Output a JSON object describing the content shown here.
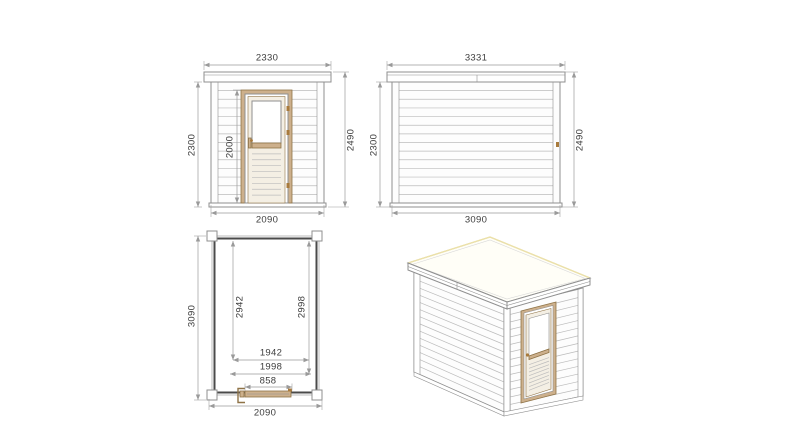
{
  "colors": {
    "line": "#8f8f8f",
    "siding": "#bcbcbc",
    "wallfill": "#fdfdfd",
    "wood": "#cdb08c",
    "wooddark": "#8f7347",
    "hardware": "#a87a3c",
    "planwall": "#4a4a4a",
    "dim": "#9a9a9a",
    "text": "#3d3d3d",
    "cream": "#f4efe4",
    "rooffill": "#fffef7",
    "roofhl": "#ece1a8"
  },
  "front_elevation": {
    "roof_width_mm": "2330",
    "wall_height_mm": "2300",
    "door_height_mm": "2000",
    "total_height_mm": "2490",
    "base_width_mm": "2090"
  },
  "side_elevation": {
    "roof_width_mm": "3331",
    "wall_height_mm": "2300",
    "total_height_mm": "2490",
    "base_width_mm": "3090"
  },
  "floor_plan": {
    "depth_mm": "3090",
    "interior_length_left_mm": "2942",
    "interior_length_right_mm": "2998",
    "interior_width_mm": "1942",
    "interior_width_outer_mm": "1998",
    "door_width_mm": "858",
    "width_mm": "2090"
  }
}
